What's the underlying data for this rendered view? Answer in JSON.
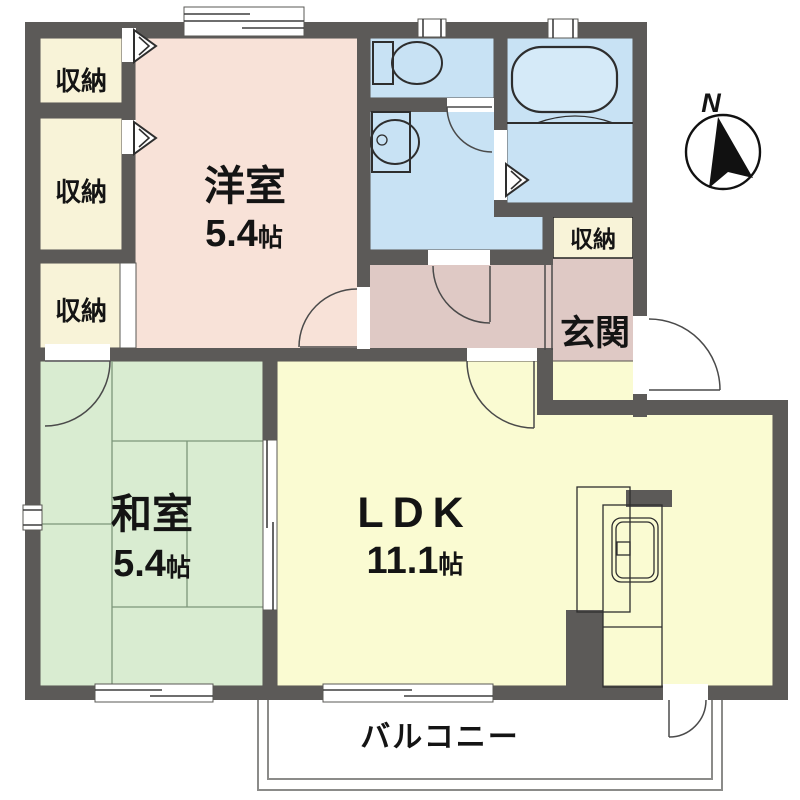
{
  "diagram": {
    "kind": "apartment-floor-plan",
    "compass": {
      "label": "N"
    },
    "rooms": {
      "closet1": {
        "label": "収納"
      },
      "closet2": {
        "label": "収納"
      },
      "closet3": {
        "label": "収納"
      },
      "western": {
        "label": "洋室",
        "size_value": "5.4",
        "size_unit": "帖"
      },
      "japanese": {
        "label": "和室",
        "size_value": "5.4",
        "size_unit": "帖"
      },
      "ldk": {
        "label": "LDK",
        "size_value": "11.1",
        "size_unit": "帖"
      },
      "entrance": {
        "label": "玄関"
      },
      "entrance_closet": {
        "label": "収納"
      },
      "balcony": {
        "label": "バルコニー"
      }
    },
    "colors": {
      "wall": "#5c5a58",
      "western_room": "#f8e2d8",
      "closet": "#f8f3d8",
      "water_rooms": "#c8e2f4",
      "bathtub": "#d5eaf8",
      "hall_entrance": "#dfc9c5",
      "japanese_room": "#d9ecd1",
      "ldk": "#fafbd2",
      "tatami_line": "#7d967a",
      "balcony_line": "#8b8b89",
      "compass_needle": "#111111",
      "outside": "#ffffff"
    }
  }
}
